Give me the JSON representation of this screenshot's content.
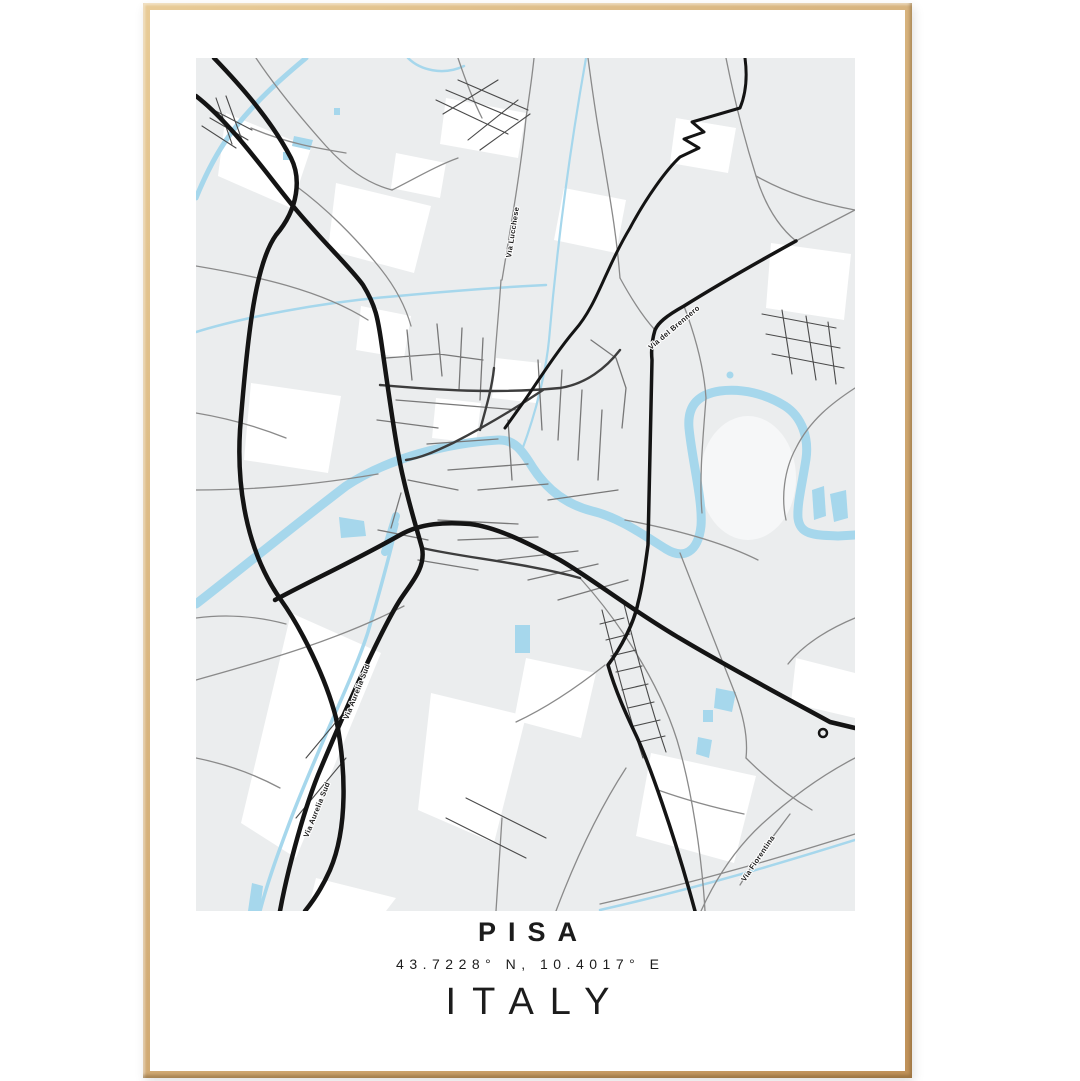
{
  "poster": {
    "title_city": "PISA",
    "coordinates": "43.7228° N, 10.4017° E",
    "title_country": "ITALY"
  },
  "map": {
    "street_labels": [
      {
        "id": "via-lucchese",
        "text": "Via Lucchese"
      },
      {
        "id": "via-del-brennero",
        "text": "Via del Brennero"
      },
      {
        "id": "via-aurelia-sud-1",
        "text": "Via Aurelia Sud"
      },
      {
        "id": "via-aurelia-sud-2",
        "text": "Via Aurelia Sud"
      },
      {
        "id": "via-fiorentina",
        "text": "Via Fiorentina"
      }
    ],
    "colors": {
      "map_bg": "#ebedee",
      "water": "#a6d7ec",
      "road_black": "#141414",
      "road_gray": "#8a8a8a",
      "frame_wood_light": "#e8cb97",
      "frame_wood_dark": "#c0925a",
      "text": "#1c1c1c"
    }
  }
}
